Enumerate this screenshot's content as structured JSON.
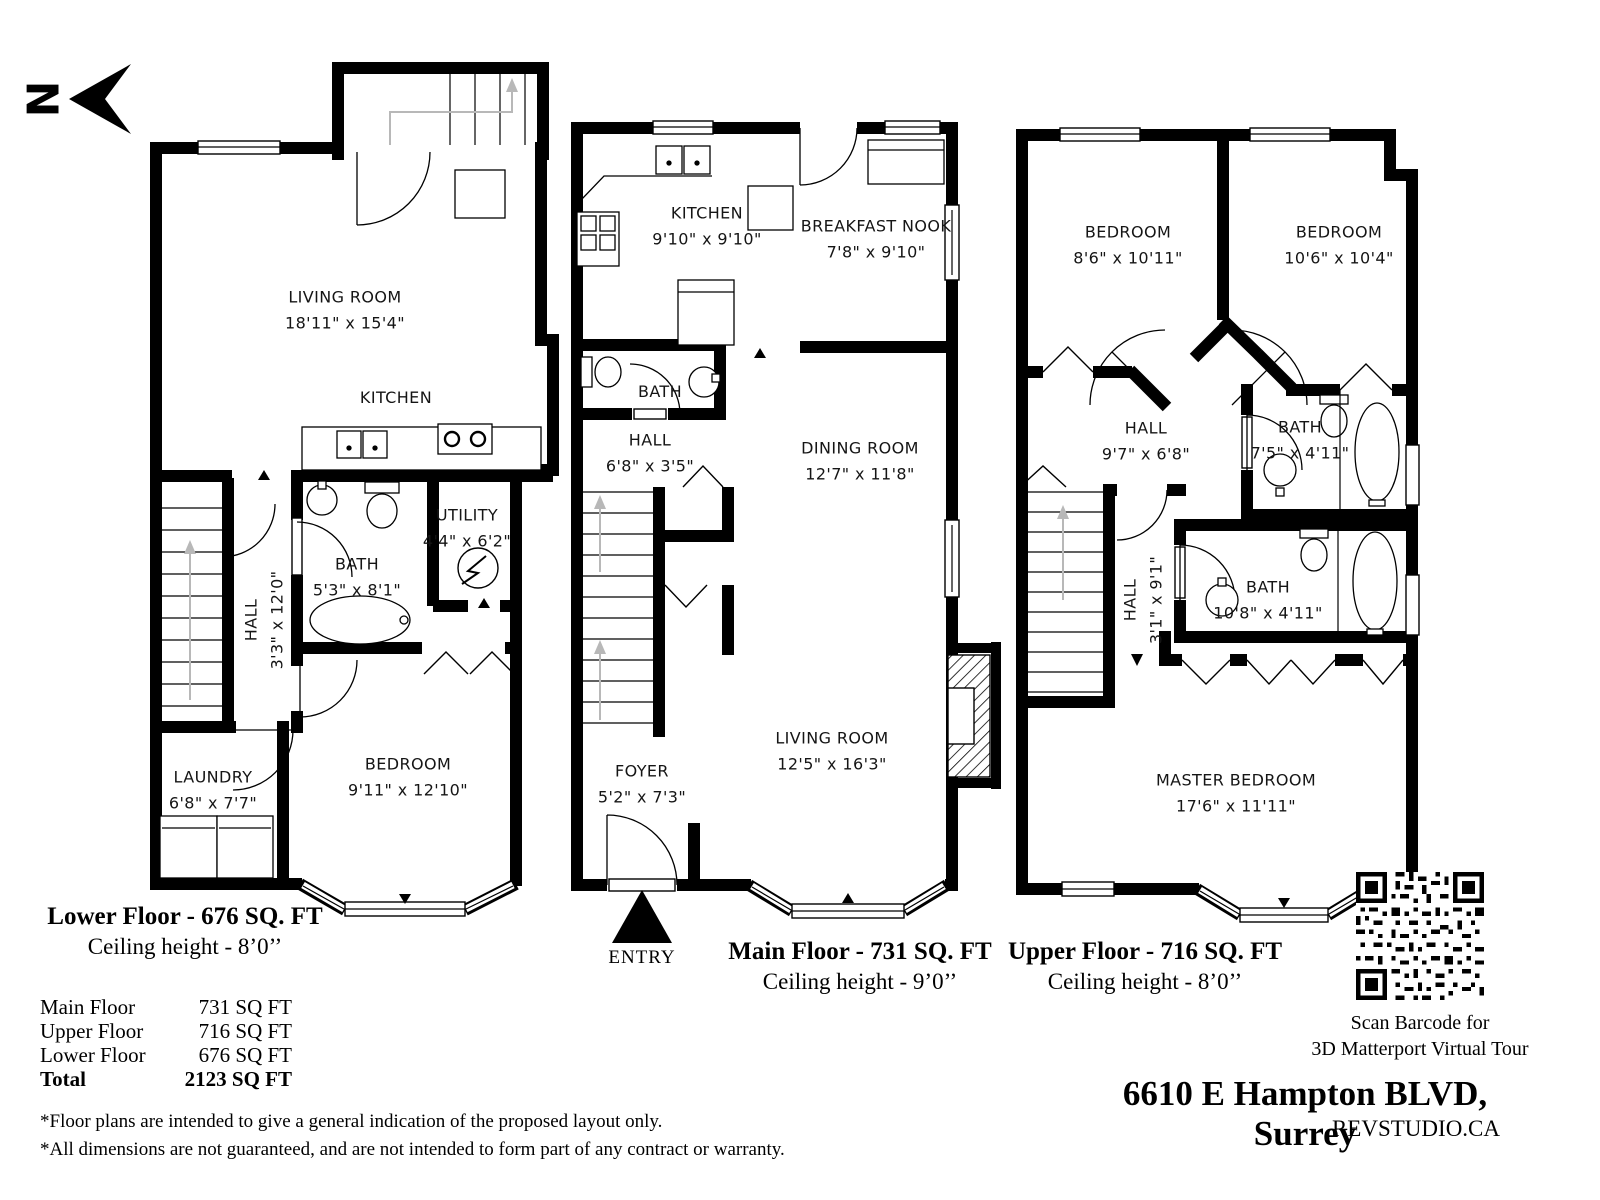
{
  "north": {
    "label": "N"
  },
  "floors": {
    "lower": {
      "title": "Lower Floor - 676 SQ. FT",
      "ceiling": "Ceiling height - 8’0’’",
      "rooms": {
        "living": {
          "name": "LIVING ROOM",
          "dims": "18'11\" x 15'4\""
        },
        "kitchen": {
          "name": "KITCHEN"
        },
        "bath": {
          "name": "BATH",
          "dims": "5'3\" x 8'1\""
        },
        "hall": {
          "name": "HALL",
          "dims": "3'3\" x 12'0\""
        },
        "utility": {
          "name": "UTILITY",
          "dims": "4'4\" x 6'2\""
        },
        "laundry": {
          "name": "LAUNDRY",
          "dims": "6'8\" x 7'7\""
        },
        "bedroom": {
          "name": "BEDROOM",
          "dims": "9'11\" x 12'10\""
        }
      }
    },
    "main": {
      "title": "Main Floor - 731 SQ. FT",
      "ceiling": "Ceiling height - 9’0’’",
      "entry_label": "ENTRY",
      "rooms": {
        "kitchen": {
          "name": "KITCHEN",
          "dims": "9'10\" x 9'10\""
        },
        "nook": {
          "name": "BREAKFAST NOOK",
          "dims": "7'8\" x 9'10\""
        },
        "bath": {
          "name": "BATH"
        },
        "hall": {
          "name": "HALL",
          "dims": "6'8\" x 3'5\""
        },
        "dining": {
          "name": "DINING ROOM",
          "dims": "12'7\" x 11'8\""
        },
        "living": {
          "name": "LIVING ROOM",
          "dims": "12'5\" x 16'3\""
        },
        "foyer": {
          "name": "FOYER",
          "dims": "5'2\" x 7'3\""
        }
      }
    },
    "upper": {
      "title": "Upper Floor - 716 SQ. FT",
      "ceiling": "Ceiling height - 8’0’’",
      "rooms": {
        "bedroom1": {
          "name": "BEDROOM",
          "dims": "8'6\" x 10'11\""
        },
        "bedroom2": {
          "name": "BEDROOM",
          "dims": "10'6\" x 10'4\""
        },
        "hall1": {
          "name": "HALL",
          "dims": "9'7\" x 6'8\""
        },
        "bath1": {
          "name": "BATH",
          "dims": "7'5\" x 4'11\""
        },
        "hall2": {
          "name": "HALL",
          "dims": "3'1\" x 9'1\""
        },
        "bath2": {
          "name": "BATH",
          "dims": "10'8\" x 4'11\""
        },
        "master": {
          "name": "MASTER BEDROOM",
          "dims": "17'6\" x 11'11\""
        }
      }
    }
  },
  "summary": {
    "rows": [
      {
        "label": "Main Floor",
        "value": "731 SQ FT"
      },
      {
        "label": "Upper Floor",
        "value": "716 SQ FT"
      },
      {
        "label": "Lower Floor",
        "value": "676 SQ FT"
      }
    ],
    "total": {
      "label": "Total",
      "value": "2123 SQ FT"
    }
  },
  "disclaimers": [
    "*Floor plans are intended to give a general indication of the proposed layout only.",
    "*All dimensions are not guaranteed, and are not intended to form part of any contract or warranty."
  ],
  "qr": {
    "line1": "Scan Barcode for",
    "line2": "3D Matterport Virtual Tour"
  },
  "footer": {
    "address": "6610 E Hampton BLVD, Surrey",
    "brand": "REVSTUDIO.CA"
  }
}
